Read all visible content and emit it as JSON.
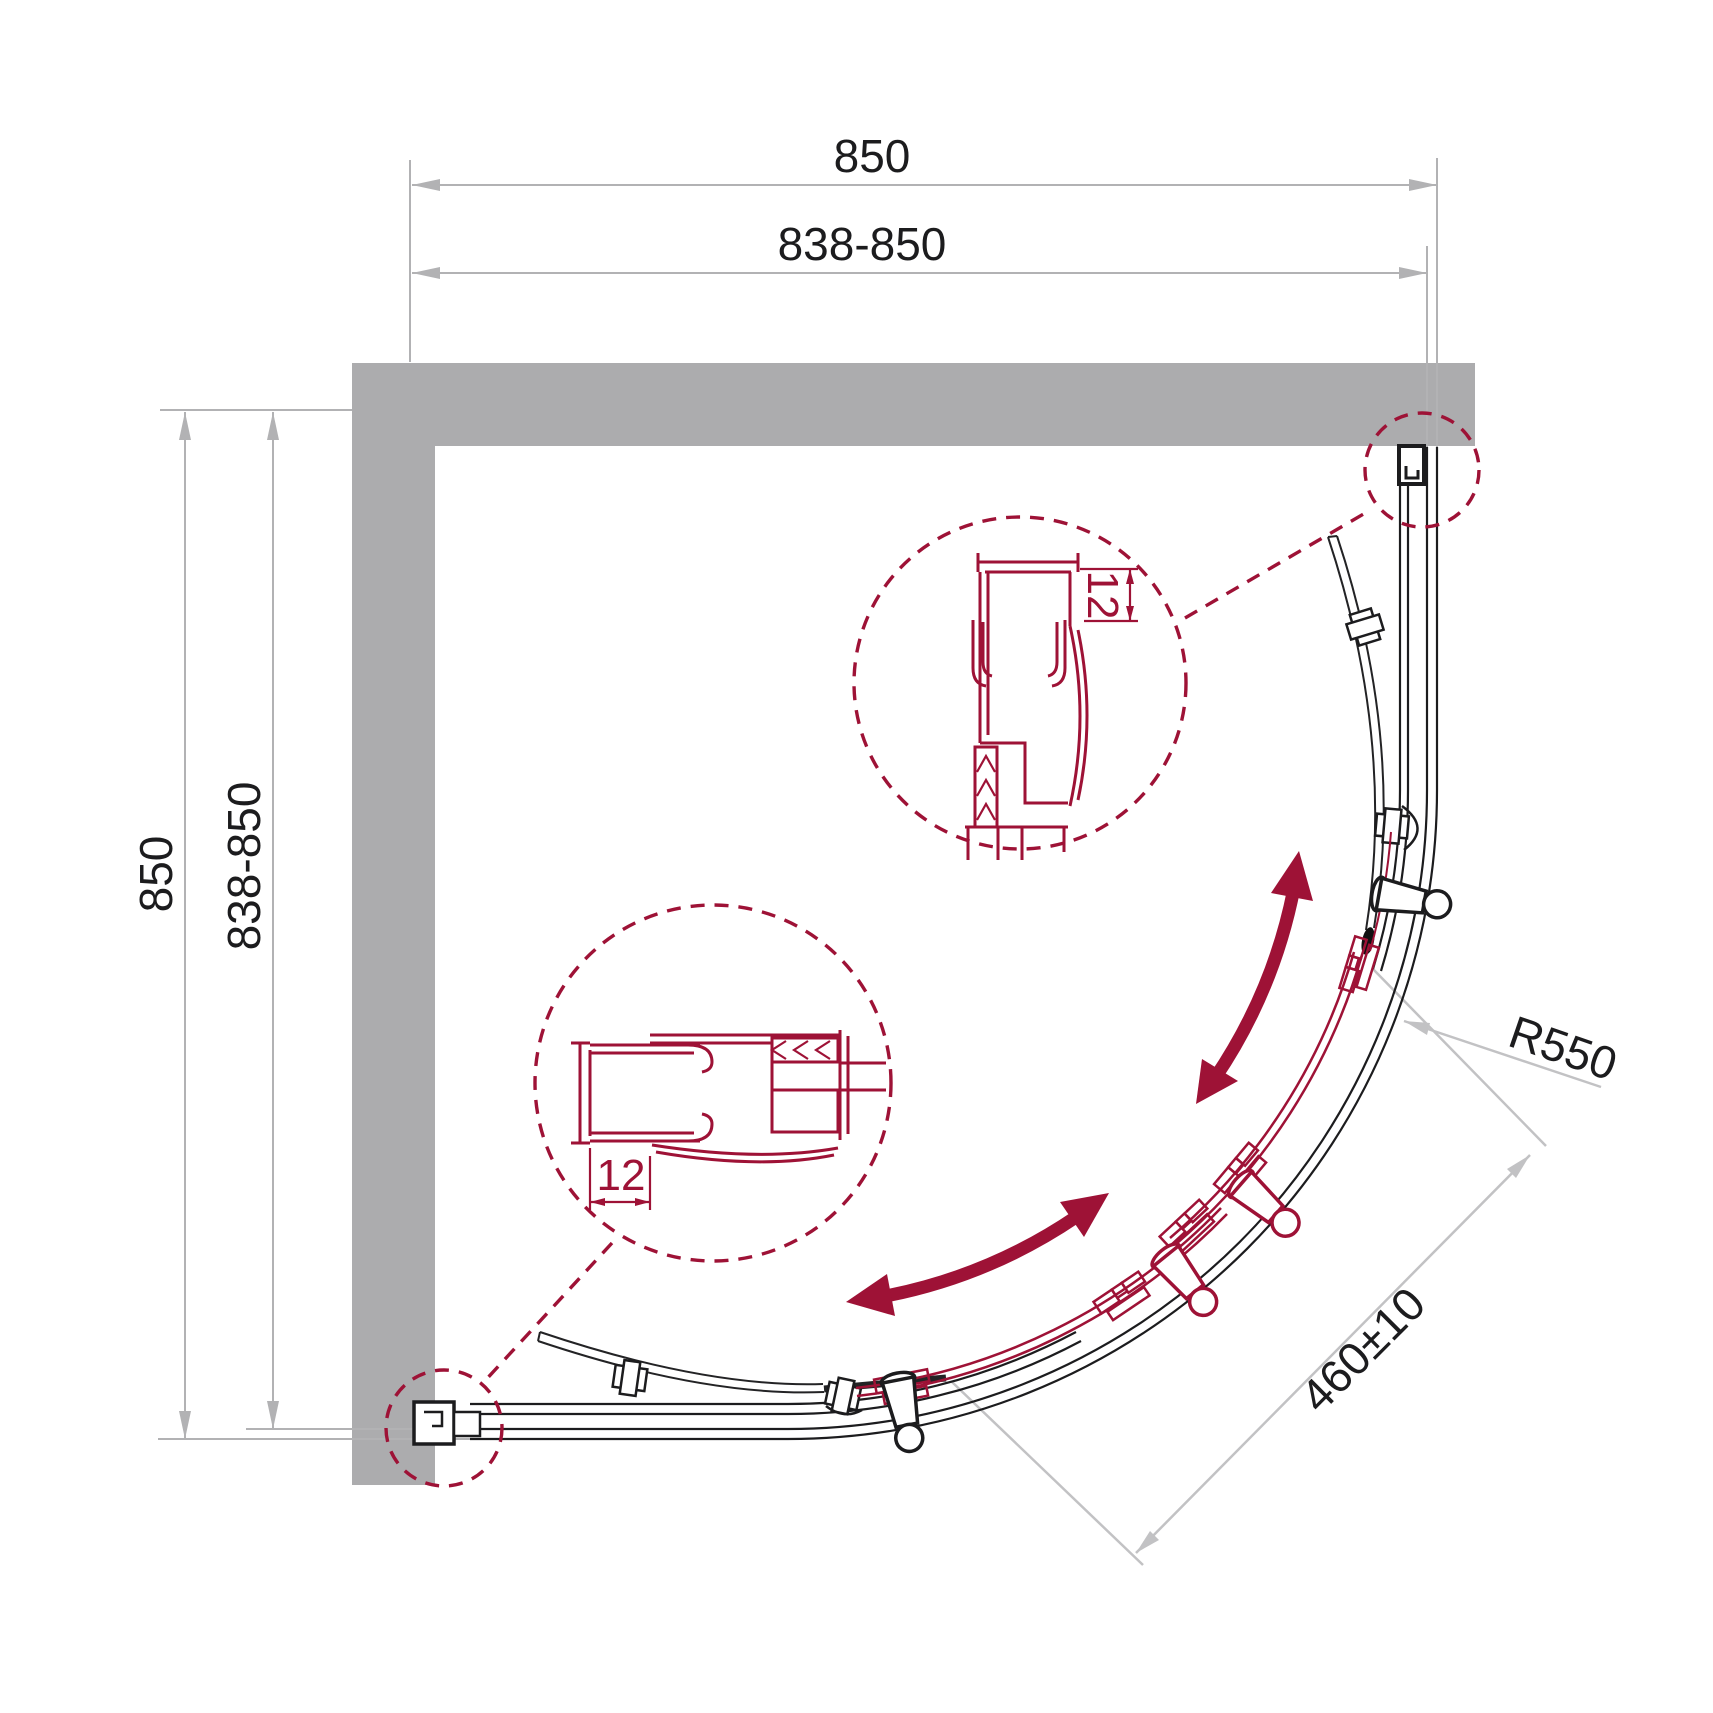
{
  "dimensions": {
    "top": {
      "outer": "850",
      "inner": "838-850"
    },
    "left": {
      "outer": "850",
      "inner": "838-850"
    },
    "radius": "R550",
    "diagonal": "460±10",
    "detail_top": "12",
    "detail_bottom": "12"
  },
  "colors": {
    "accent_red": "#9e1236",
    "wall_gray": "#acacae",
    "dim_line_gray": "#b2b2b4",
    "leader_gray": "#c2c2c4",
    "line_black": "#1c1c1e"
  },
  "icons": {
    "detail_circle_top": "magnified-section-wall-profile",
    "detail_circle_bottom": "magnified-section-wall-profile",
    "swing_arrows": "door-slide-direction"
  }
}
